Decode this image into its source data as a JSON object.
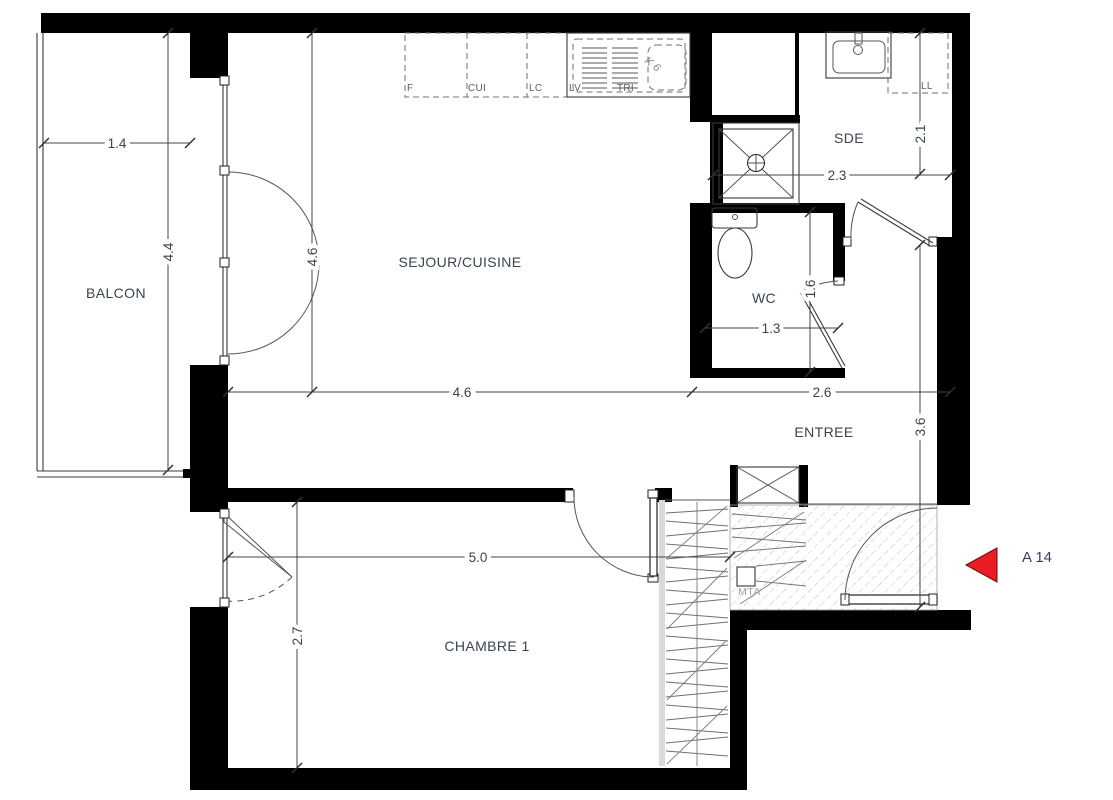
{
  "rooms": {
    "balcony": "BALCON",
    "living": "SEJOUR/CUISINE",
    "shower_room": "SDE",
    "wc": "WC",
    "entry": "ENTREE",
    "bedroom": "CHAMBRE 1"
  },
  "dims": {
    "balcony_width": "1.4",
    "balcony_depth": "4.4",
    "living_height": "4.6",
    "living_width": "4.6",
    "entry_width": "2.6",
    "sde_height": "2.1",
    "sde_width": "2.3",
    "wc_height": "1.6",
    "wc_width": "1.3",
    "entry_height": "3.6",
    "bedroom_width": "5.0",
    "bedroom_height": "2.7"
  },
  "kitchen": {
    "fridge": "F",
    "cooker": "CUI",
    "lc": "LC",
    "dishwasher": "LV",
    "tri": "TRI",
    "washer": "LL",
    "handwritten_note": "K 6"
  },
  "common_area": {
    "shaft_label": "MTA"
  },
  "marker": {
    "label": "A 14",
    "color": "#ec1c24"
  },
  "colors": {
    "wall": "#000000",
    "line": "#3a3a3a",
    "text": "#3b4250",
    "hatch": "#b9bdc2",
    "muted_text": "#9aa0a8",
    "accent_red": "#ec1c24"
  }
}
